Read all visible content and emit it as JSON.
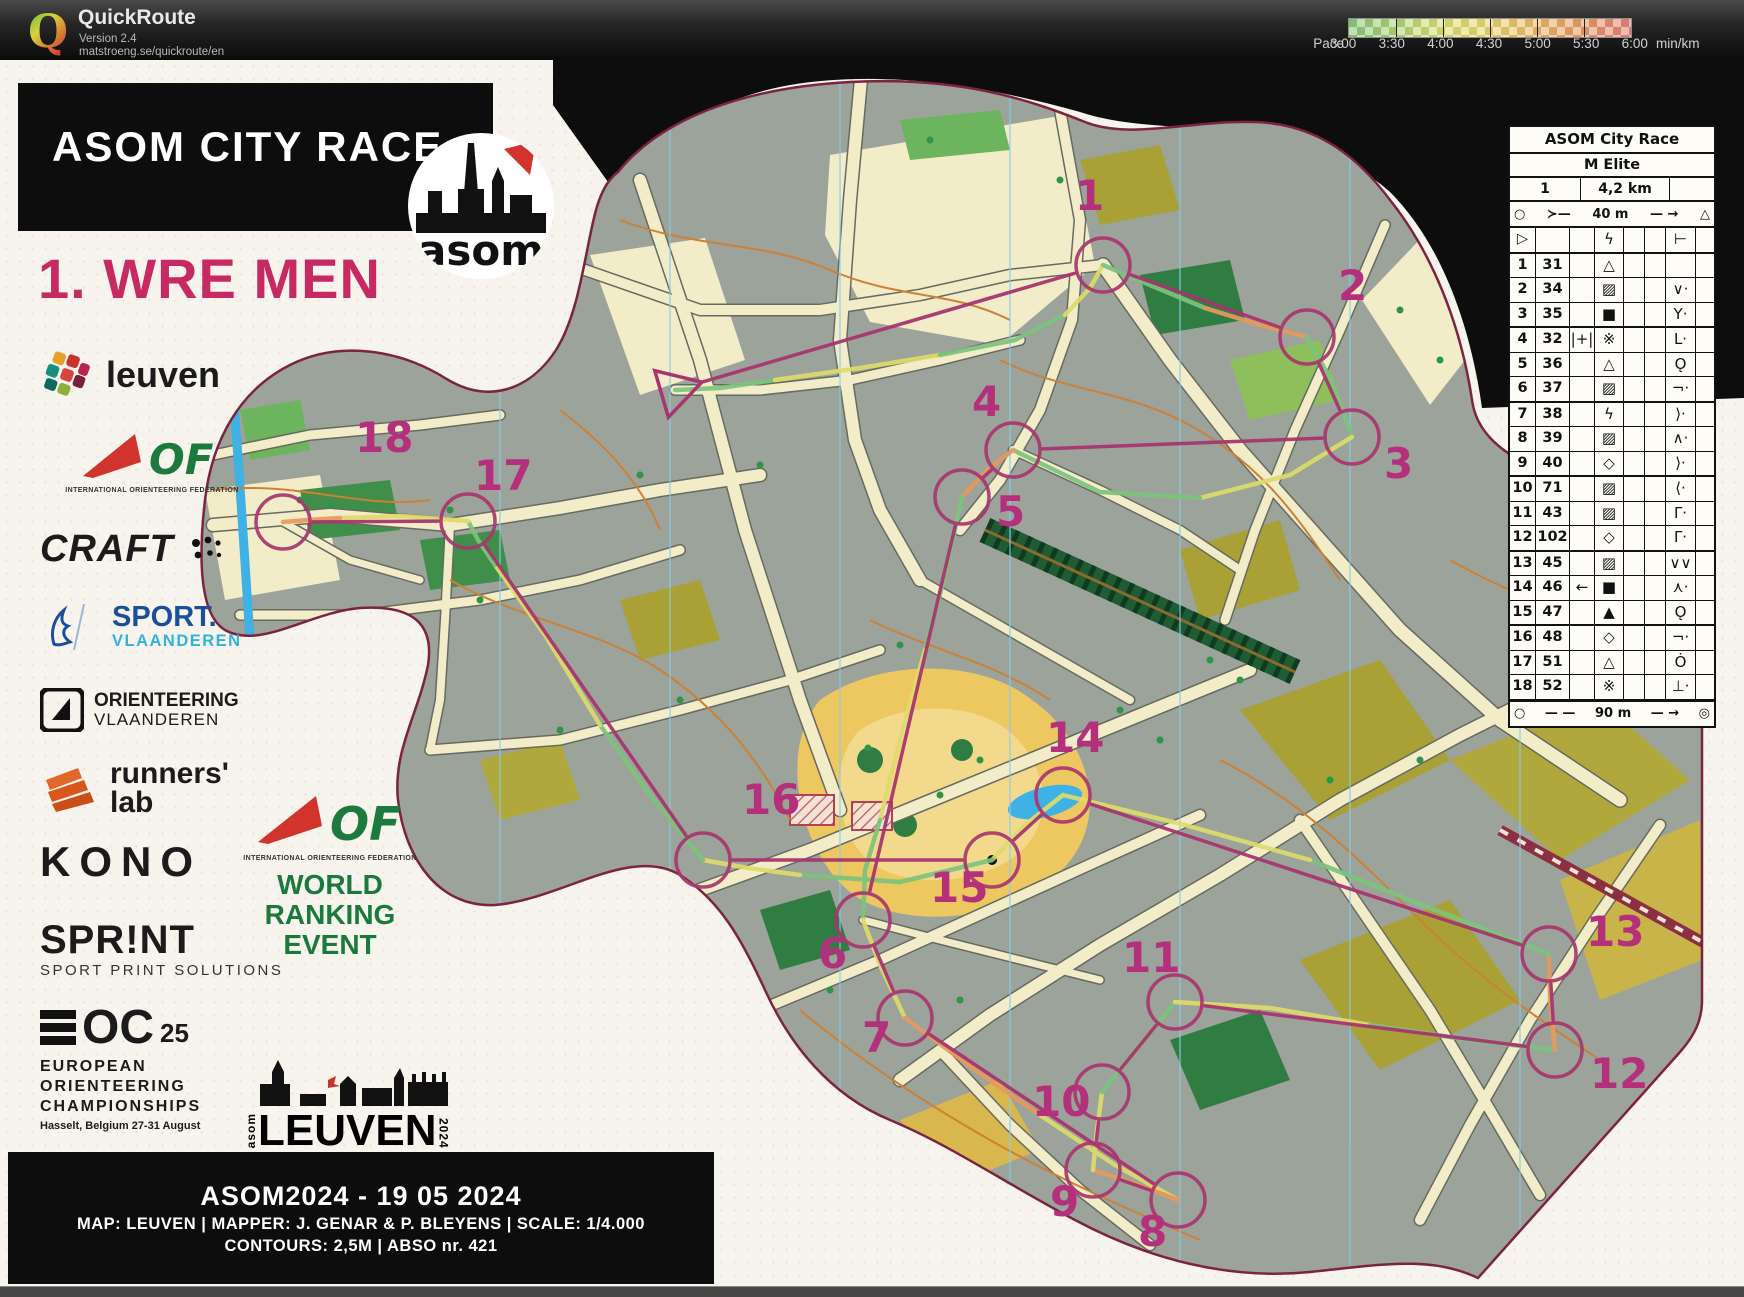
{
  "app": {
    "name": "QuickRoute",
    "version": "Version 2.4",
    "url": "matstroeng.se/quickroute/en"
  },
  "legend": {
    "label": "Pace",
    "unit": "min/km",
    "ticks": [
      "3:00",
      "3:30",
      "4:00",
      "4:30",
      "5:00",
      "5:30",
      "6:00"
    ]
  },
  "event": {
    "banner": "ASOM CITY RACE",
    "course_title": "1. WRE MEN",
    "club": "asom"
  },
  "sponsors": {
    "leuven": "leuven",
    "iof_caption": "INTERNATIONAL ORIENTEERING FEDERATION",
    "iof_of": "OF",
    "craft": "CRAFT",
    "sport_vl_1": "SPORT.",
    "sport_vl_2": "VLAANDEREN",
    "orient_vl_1": "ORIENTEERING",
    "orient_vl_2": "VLAANDEREN",
    "runners_1": "runners'",
    "runners_2": "lab",
    "kono": "KONO",
    "sprint": "SPR!NT",
    "sprint_sub": "SPORT PRINT SOLUTIONS",
    "eoc_oc": "OC",
    "eoc_25": "25",
    "eoc_lines": [
      "EUROPEAN",
      "ORIENTEERING",
      "CHAMPIONSHIPS"
    ],
    "eoc_sub": "Hasselt, Belgium  27-31 August"
  },
  "wre": {
    "lines": [
      "WORLD",
      "RANKING",
      "EVENT"
    ],
    "iof_of": "OF",
    "caption": "INTERNATIONAL ORIENTEERING FEDERATION"
  },
  "leuven_logo": {
    "city": "LEUVEN",
    "side_left": "asom",
    "side_right": "2024"
  },
  "credits": {
    "line1": "ASOM2024 - 19 05 2024",
    "line2": "MAP: LEUVEN   |   MAPPER: J. GENAR & P. BLEYENS   |   SCALE:  1/4.000",
    "line3": "CONTOURS: 2,5M   |   ABSO nr. 421"
  },
  "control_sheet": {
    "title": "ASOM City Race",
    "class": "M Elite",
    "course_no": "1",
    "length": "4,2 km",
    "climb": "",
    "start_sym": "○",
    "start_fork": "≻—",
    "start_distance": "40 m",
    "start_arrow": "— →",
    "start_tri": "△",
    "finish_sym": "○",
    "finish_dash": "— —",
    "finish_distance": "90 m",
    "finish_arrow": "— →",
    "finish_ring": "◎",
    "rows": [
      {
        "a": "▷",
        "b": "",
        "c": "",
        "d": "ϟ",
        "e": "",
        "f": "",
        "g": "⊢",
        "h": ""
      },
      {
        "a": "1",
        "b": "31",
        "c": "",
        "d": "△",
        "e": "",
        "f": "",
        "g": "",
        "h": ""
      },
      {
        "a": "2",
        "b": "34",
        "c": "",
        "d": "▨",
        "e": "",
        "f": "",
        "g": "∨·",
        "h": ""
      },
      {
        "a": "3",
        "b": "35",
        "c": "",
        "d": "■",
        "e": "",
        "f": "",
        "g": "Y·",
        "h": ""
      },
      {
        "a": "4",
        "b": "32",
        "c": "|+|",
        "d": "※",
        "e": "",
        "f": "",
        "g": "L·",
        "h": ""
      },
      {
        "a": "5",
        "b": "36",
        "c": "",
        "d": "△",
        "e": "",
        "f": "",
        "g": "Ǫ",
        "h": ""
      },
      {
        "a": "6",
        "b": "37",
        "c": "",
        "d": "▨",
        "e": "",
        "f": "",
        "g": "¬·",
        "h": ""
      },
      {
        "a": "7",
        "b": "38",
        "c": "",
        "d": "ϟ",
        "e": "",
        "f": "",
        "g": "⟩·",
        "h": ""
      },
      {
        "a": "8",
        "b": "39",
        "c": "",
        "d": "▨",
        "e": "",
        "f": "",
        "g": "∧·",
        "h": ""
      },
      {
        "a": "9",
        "b": "40",
        "c": "",
        "d": "◇",
        "e": "",
        "f": "",
        "g": "⟩·",
        "h": ""
      },
      {
        "a": "10",
        "b": "71",
        "c": "",
        "d": "▨",
        "e": "",
        "f": "",
        "g": "⟨·",
        "h": ""
      },
      {
        "a": "11",
        "b": "43",
        "c": "",
        "d": "▨",
        "e": "",
        "f": "",
        "g": "Γ·",
        "h": ""
      },
      {
        "a": "12",
        "b": "102",
        "c": "",
        "d": "◇",
        "e": "",
        "f": "",
        "g": "Γ·",
        "h": ""
      },
      {
        "a": "13",
        "b": "45",
        "c": "",
        "d": "▨",
        "e": "",
        "f": "",
        "g": "∨∨",
        "h": ""
      },
      {
        "a": "14",
        "b": "46",
        "c": "←",
        "d": "■",
        "e": "",
        "f": "",
        "g": "⋏·",
        "h": ""
      },
      {
        "a": "15",
        "b": "47",
        "c": "",
        "d": "▲",
        "e": "",
        "f": "",
        "g": "Ǫ",
        "h": ""
      },
      {
        "a": "16",
        "b": "48",
        "c": "",
        "d": "◇",
        "e": "",
        "f": "",
        "g": "¬·",
        "h": ""
      },
      {
        "a": "17",
        "b": "51",
        "c": "",
        "d": "△",
        "e": "",
        "f": "",
        "g": "Ȯ",
        "h": ""
      },
      {
        "a": "18",
        "b": "52",
        "c": "",
        "d": "※",
        "e": "",
        "f": "",
        "g": "⊥·",
        "h": ""
      }
    ]
  },
  "course": {
    "start": {
      "x": 675,
      "y": 330
    },
    "controls": [
      {
        "n": "1",
        "x": 1103,
        "y": 205,
        "lx": 1075,
        "ly": 150
      },
      {
        "n": "2",
        "x": 1307,
        "y": 277,
        "lx": 1338,
        "ly": 240
      },
      {
        "n": "3",
        "x": 1352,
        "y": 377,
        "lx": 1384,
        "ly": 418
      },
      {
        "n": "4",
        "x": 1013,
        "y": 390,
        "lx": 972,
        "ly": 356
      },
      {
        "n": "5",
        "x": 962,
        "y": 437,
        "lx": 996,
        "ly": 466
      },
      {
        "n": "6",
        "x": 863,
        "y": 860,
        "lx": 818,
        "ly": 908
      },
      {
        "n": "7",
        "x": 905,
        "y": 958,
        "lx": 862,
        "ly": 992
      },
      {
        "n": "8",
        "x": 1178,
        "y": 1140,
        "lx": 1138,
        "ly": 1186
      },
      {
        "n": "9",
        "x": 1093,
        "y": 1110,
        "lx": 1050,
        "ly": 1156
      },
      {
        "n": "10",
        "x": 1102,
        "y": 1032,
        "lx": 1032,
        "ly": 1056
      },
      {
        "n": "11",
        "x": 1175,
        "y": 942,
        "lx": 1122,
        "ly": 912
      },
      {
        "n": "12",
        "x": 1555,
        "y": 990,
        "lx": 1590,
        "ly": 1028
      },
      {
        "n": "13",
        "x": 1549,
        "y": 894,
        "lx": 1586,
        "ly": 886
      },
      {
        "n": "14",
        "x": 1063,
        "y": 735,
        "lx": 1046,
        "ly": 692
      },
      {
        "n": "15",
        "x": 992,
        "y": 800,
        "lx": 930,
        "ly": 842
      },
      {
        "n": "16",
        "x": 703,
        "y": 800,
        "lx": 742,
        "ly": 754
      },
      {
        "n": "17",
        "x": 468,
        "y": 461,
        "lx": 474,
        "ly": 430
      },
      {
        "n": "18",
        "x": 283,
        "y": 462,
        "lx": 355,
        "ly": 392
      }
    ]
  },
  "route": {
    "segments": [
      {
        "c": "g",
        "p": "675,330 720,328 775,320"
      },
      {
        "c": "y",
        "p": "775,320 860,308 940,295"
      },
      {
        "c": "g",
        "p": "940,295 1015,280 1065,255"
      },
      {
        "c": "y",
        "p": "1065,255 1090,228 1103,205"
      },
      {
        "c": "g",
        "p": "1103,205 1150,225 1205,248"
      },
      {
        "c": "o",
        "p": "1205,248 1260,265 1307,277"
      },
      {
        "c": "g",
        "p": "1307,277 1332,322 1352,377"
      },
      {
        "c": "y",
        "p": "1352,377 1290,415 1200,438"
      },
      {
        "c": "g",
        "p": "1200,438 1100,432 1013,390"
      },
      {
        "c": "o",
        "p": "1013,390 985,412 962,437"
      },
      {
        "c": "g",
        "p": "962,437 945,515 925,590"
      },
      {
        "c": "y",
        "p": "925,590 900,680 880,760"
      },
      {
        "c": "g",
        "p": "880,760 865,810 863,860"
      },
      {
        "c": "y",
        "p": "863,860 880,905 905,958"
      },
      {
        "c": "o",
        "p": "905,958 975,1010 1040,1055"
      },
      {
        "c": "y",
        "p": "1040,1055 1115,1105 1178,1140"
      },
      {
        "c": "o",
        "p": "1178,1140 1130,1122 1093,1110"
      },
      {
        "c": "y",
        "p": "1093,1110 1097,1070 1102,1032"
      },
      {
        "c": "g",
        "p": "1102,1032 1140,985 1175,942"
      },
      {
        "c": "y",
        "p": "1175,942 1270,948 1370,965"
      },
      {
        "c": "g",
        "p": "1370,965 1470,980 1555,990"
      },
      {
        "c": "o",
        "p": "1555,990 1550,940 1549,894"
      },
      {
        "c": "g",
        "p": "1549,894 1430,848 1310,800"
      },
      {
        "c": "y",
        "p": "1310,800 1185,765 1063,735"
      },
      {
        "c": "y",
        "p": "1063,735 1025,765 992,800"
      },
      {
        "c": "g",
        "p": "992,800 900,822 800,815"
      },
      {
        "c": "y",
        "p": "800,815 748,808 703,800"
      },
      {
        "c": "g",
        "p": "703,800 650,735 600,665"
      },
      {
        "c": "y",
        "p": "600,665 545,575 495,505"
      },
      {
        "c": "g",
        "p": "495,505 478,480 468,461"
      },
      {
        "c": "y",
        "p": "468,461 400,456 340,458"
      },
      {
        "c": "o",
        "p": "340,458 308,460 283,462"
      }
    ]
  },
  "colors": {
    "course_magenta": "#a8356f",
    "number_magenta": "#b5307c",
    "pace_g": "#7cc47c",
    "pace_y": "#dedc6a",
    "pace_o": "#e8995e",
    "paper": "#f7f4ed",
    "buildings": "#9ba39b",
    "street": "#f3ecc9",
    "olive": "#a9a135",
    "yellow_open": "#e9c75e",
    "green_dark": "#2c7a3e",
    "water": "#3fb1e5",
    "contour": "#cc8136",
    "railway": "#8c2f42"
  }
}
